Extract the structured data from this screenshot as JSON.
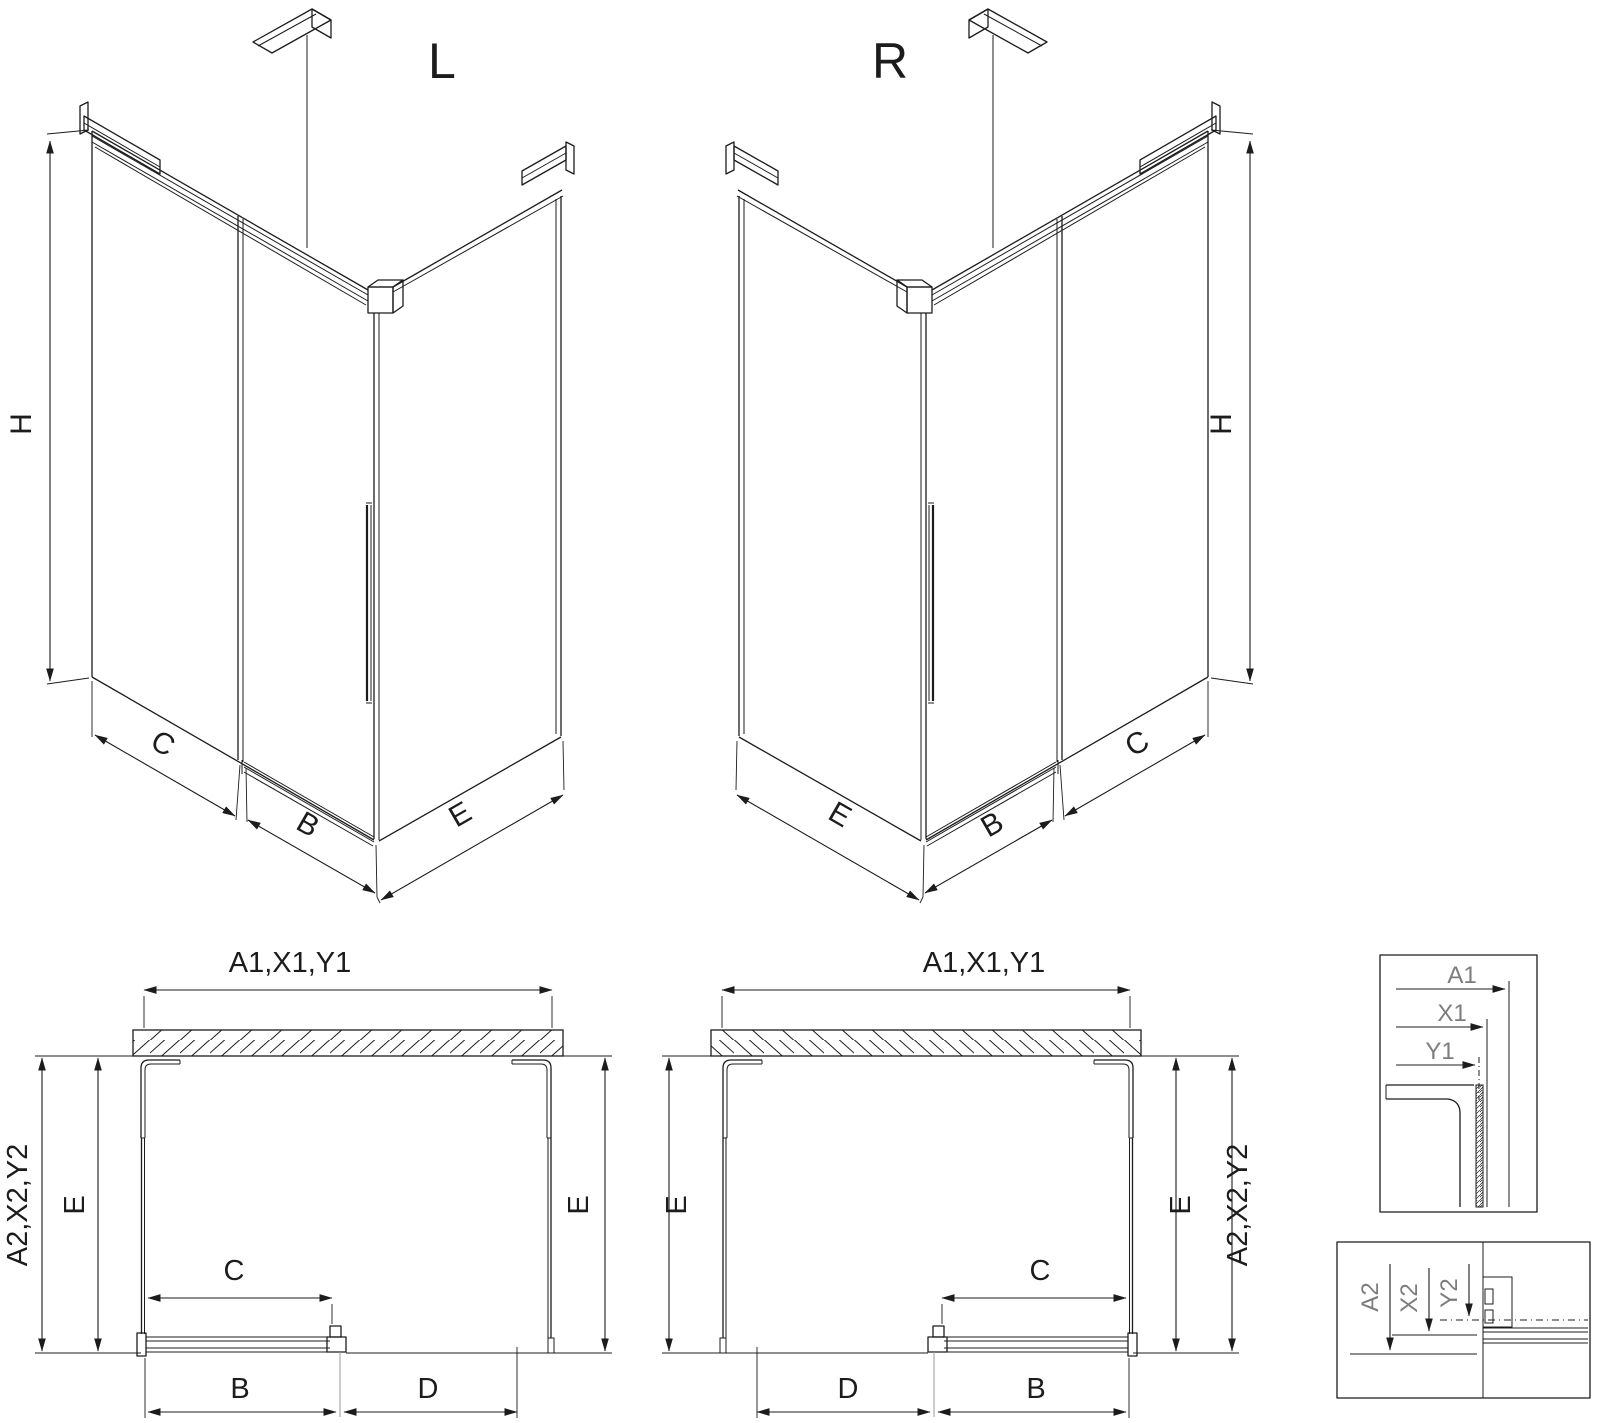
{
  "background": "#ffffff",
  "line_color": "#1c1c1c",
  "detail_label_color": "#7d7d7d",
  "iso_left": {
    "title": "L",
    "dim_height": "H",
    "dim_back_panel": "C",
    "dim_door": "B",
    "dim_side_panel": "E"
  },
  "iso_right": {
    "title": "R",
    "dim_height": "H",
    "dim_back_panel": "C",
    "dim_door": "B",
    "dim_side_panel": "E"
  },
  "plan_left": {
    "dim_width_top": "A1,X1,Y1",
    "dim_depth_outer": "A2,X2,Y2",
    "dim_depth_left": "E",
    "dim_depth_right": "E",
    "dim_door_travel": "C",
    "dim_door": "B",
    "dim_fixed_panel": "D"
  },
  "plan_right": {
    "dim_width_top": "A1,X1,Y1",
    "dim_depth_outer": "A2,X2,Y2",
    "dim_depth_left": "E",
    "dim_depth_right": "E",
    "dim_door_travel": "C",
    "dim_door": "B",
    "dim_fixed_panel": "D"
  },
  "detail_top": {
    "dim_a": "A1",
    "dim_x": "X1",
    "dim_y": "Y1"
  },
  "detail_bottom": {
    "dim_a": "A2",
    "dim_x": "X2",
    "dim_y": "Y2"
  }
}
